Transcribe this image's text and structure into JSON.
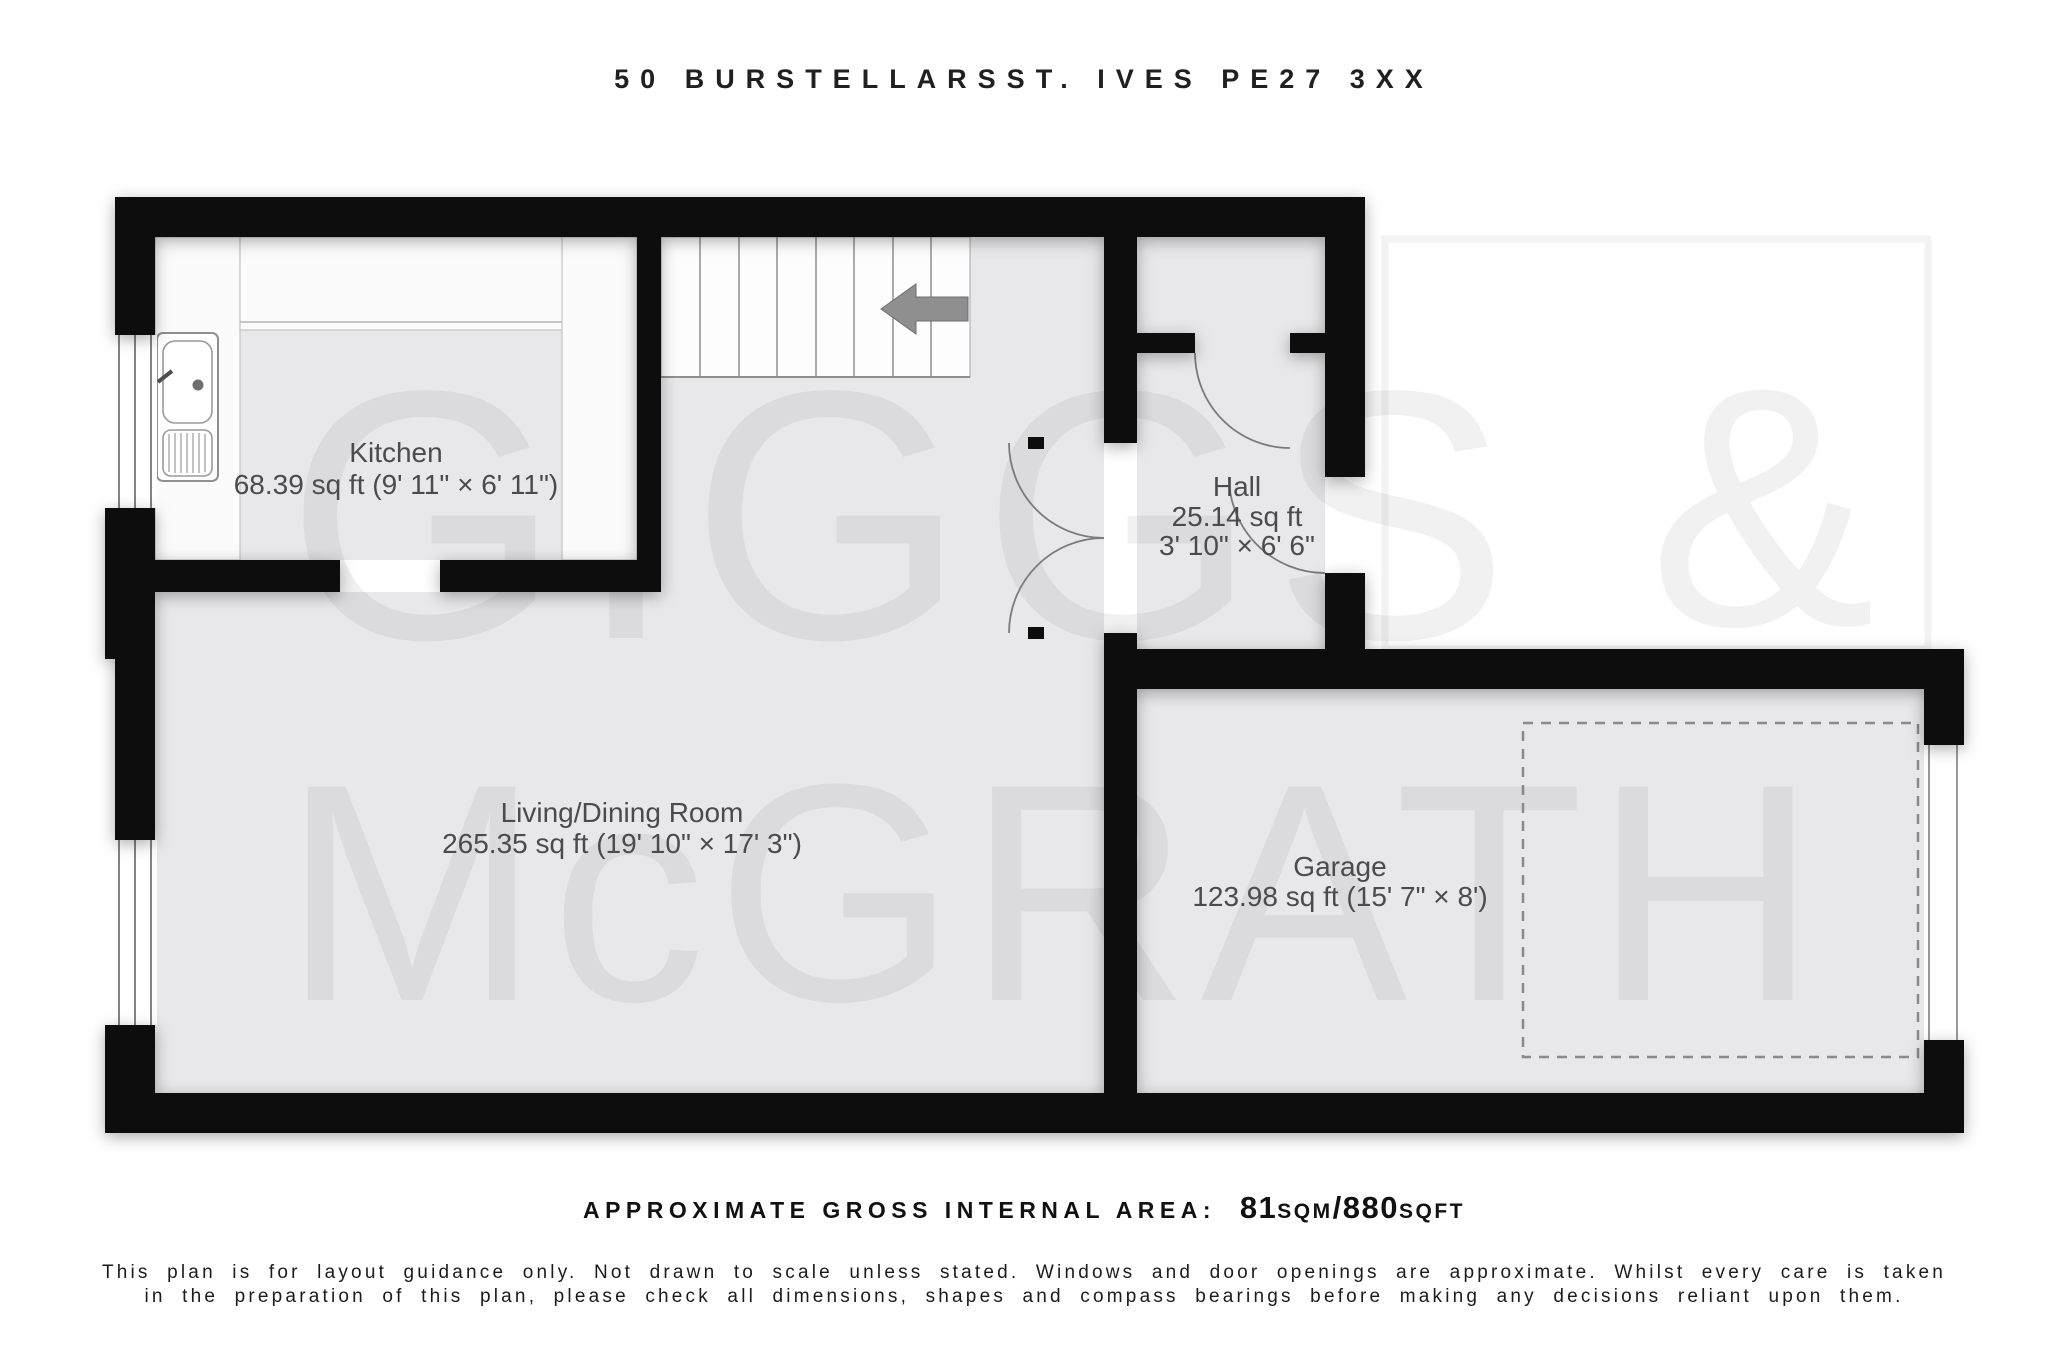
{
  "title": "50 BURSTELLARSST. IVES PE27 3XX",
  "watermark": {
    "word1": "GIGGS",
    "amp": "&",
    "word2": "McGRATH"
  },
  "rooms": {
    "kitchen": {
      "name": "Kitchen",
      "dims": "68.39 sq ft (9' 11\" × 6' 11\")"
    },
    "hall": {
      "name": "Hall",
      "area": "25.14 sq ft",
      "dims": "3' 10\" × 6' 6\""
    },
    "living": {
      "name": "Living/Dining Room",
      "dims": "265.35 sq ft (19' 10\" × 17' 3\")"
    },
    "garage": {
      "name": "Garage",
      "dims": "123.98 sq ft (15' 7\" × 8')"
    }
  },
  "footer": {
    "area_label": "APPROXIMATE GROSS INTERNAL AREA:",
    "sqm_value": "81",
    "sqm_unit": "SQM",
    "separator": "/",
    "sqft_value": "880",
    "sqft_unit": "SQFT",
    "disclaimer_line1": "This plan is for layout guidance only. Not drawn to scale unless stated. Windows and door openings are approximate. Whilst every care is taken",
    "disclaimer_line2": "in the preparation of this plan, please check all dimensions, shapes and compass bearings before making any decisions reliant upon them."
  },
  "colors": {
    "wall": "#0d0d0d",
    "floor": "#e8e8ea",
    "fixture": "#fbfbfb",
    "label_text": "#4b4b4b",
    "door_arc": "#7a7a7a",
    "stair_arrow": "#8f8f8f",
    "watermark_frame": "#f3f3f3"
  }
}
